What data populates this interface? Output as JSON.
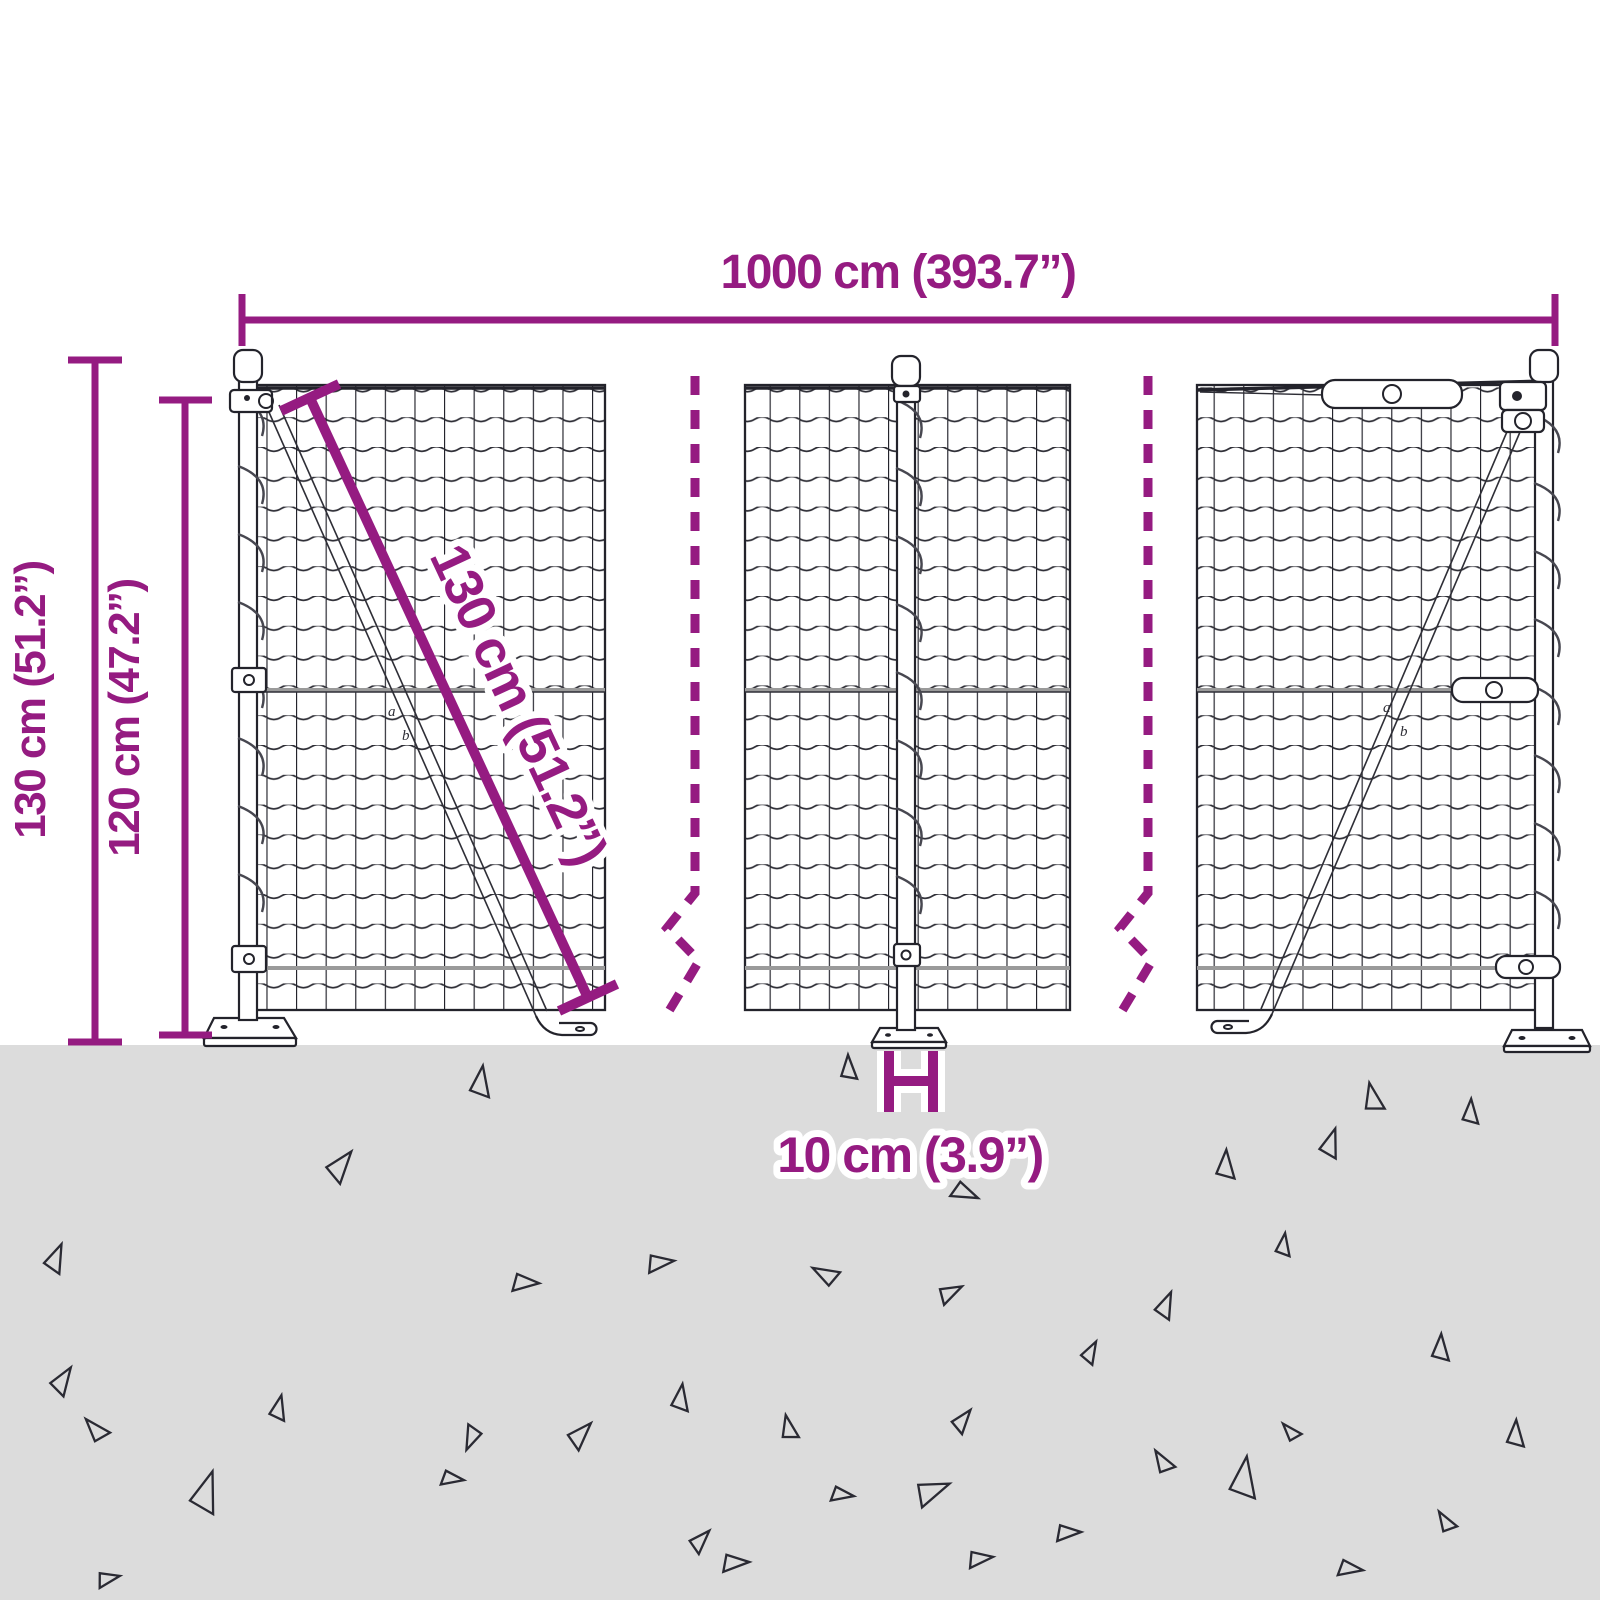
{
  "colors": {
    "accent": "#951b81",
    "ground": "#dcdcdc",
    "ink": "#23232b",
    "wire": "#9a9a9a"
  },
  "dimensions": {
    "width": {
      "label": "1000 cm (393.7”)"
    },
    "height_total": {
      "label": "130 cm (51.2”)"
    },
    "height_mesh": {
      "label": "120 cm (47.2”)"
    },
    "diagonal": {
      "label": "130 cm (51.2”)"
    },
    "post_spacing": {
      "label": "10 cm (3.9”)"
    }
  },
  "brace_callouts": {
    "a": "a",
    "b": "b"
  },
  "ground": {
    "triangles": [
      {
        "x": 480,
        "y": 1082,
        "s": 30,
        "r": 10
      },
      {
        "x": 848,
        "y": 1068,
        "s": 24,
        "r": 0
      },
      {
        "x": 1372,
        "y": 1098,
        "s": 28,
        "r": 350
      },
      {
        "x": 1470,
        "y": 1112,
        "s": 24,
        "r": 5
      },
      {
        "x": 340,
        "y": 1165,
        "s": 32,
        "r": 40
      },
      {
        "x": 1330,
        "y": 1143,
        "s": 28,
        "r": 20
      },
      {
        "x": 1225,
        "y": 1165,
        "s": 28,
        "r": 5
      },
      {
        "x": 965,
        "y": 1192,
        "s": 26,
        "r": 115
      },
      {
        "x": 55,
        "y": 1258,
        "s": 28,
        "r": 25
      },
      {
        "x": 525,
        "y": 1282,
        "s": 26,
        "r": 95
      },
      {
        "x": 660,
        "y": 1262,
        "s": 26,
        "r": 85
      },
      {
        "x": 825,
        "y": 1275,
        "s": 26,
        "r": 300
      },
      {
        "x": 950,
        "y": 1292,
        "s": 24,
        "r": 65
      },
      {
        "x": 1283,
        "y": 1245,
        "s": 22,
        "r": 10
      },
      {
        "x": 1165,
        "y": 1305,
        "s": 26,
        "r": 25
      },
      {
        "x": 62,
        "y": 1380,
        "s": 28,
        "r": 35
      },
      {
        "x": 680,
        "y": 1398,
        "s": 26,
        "r": 10
      },
      {
        "x": 472,
        "y": 1438,
        "s": 24,
        "r": 205
      },
      {
        "x": 1440,
        "y": 1348,
        "s": 26,
        "r": 5
      },
      {
        "x": 1090,
        "y": 1352,
        "s": 22,
        "r": 30
      },
      {
        "x": 95,
        "y": 1430,
        "s": 26,
        "r": 320
      },
      {
        "x": 278,
        "y": 1408,
        "s": 24,
        "r": 15
      },
      {
        "x": 580,
        "y": 1434,
        "s": 28,
        "r": 45
      },
      {
        "x": 788,
        "y": 1428,
        "s": 24,
        "r": 350
      },
      {
        "x": 962,
        "y": 1420,
        "s": 24,
        "r": 40
      },
      {
        "x": 1162,
        "y": 1462,
        "s": 24,
        "r": 330
      },
      {
        "x": 1290,
        "y": 1432,
        "s": 20,
        "r": 320
      },
      {
        "x": 1515,
        "y": 1434,
        "s": 26,
        "r": 5
      },
      {
        "x": 205,
        "y": 1492,
        "s": 40,
        "r": 20
      },
      {
        "x": 452,
        "y": 1478,
        "s": 22,
        "r": 100
      },
      {
        "x": 842,
        "y": 1494,
        "s": 22,
        "r": 100
      },
      {
        "x": 932,
        "y": 1490,
        "s": 34,
        "r": 70
      },
      {
        "x": 1068,
        "y": 1532,
        "s": 24,
        "r": 90
      },
      {
        "x": 1243,
        "y": 1478,
        "s": 40,
        "r": 10
      },
      {
        "x": 1445,
        "y": 1522,
        "s": 22,
        "r": 330
      },
      {
        "x": 735,
        "y": 1562,
        "s": 26,
        "r": 90
      },
      {
        "x": 108,
        "y": 1578,
        "s": 22,
        "r": 80
      },
      {
        "x": 1350,
        "y": 1568,
        "s": 24,
        "r": 100
      },
      {
        "x": 700,
        "y": 1540,
        "s": 24,
        "r": 45
      },
      {
        "x": 980,
        "y": 1558,
        "s": 24,
        "r": 85
      }
    ]
  }
}
